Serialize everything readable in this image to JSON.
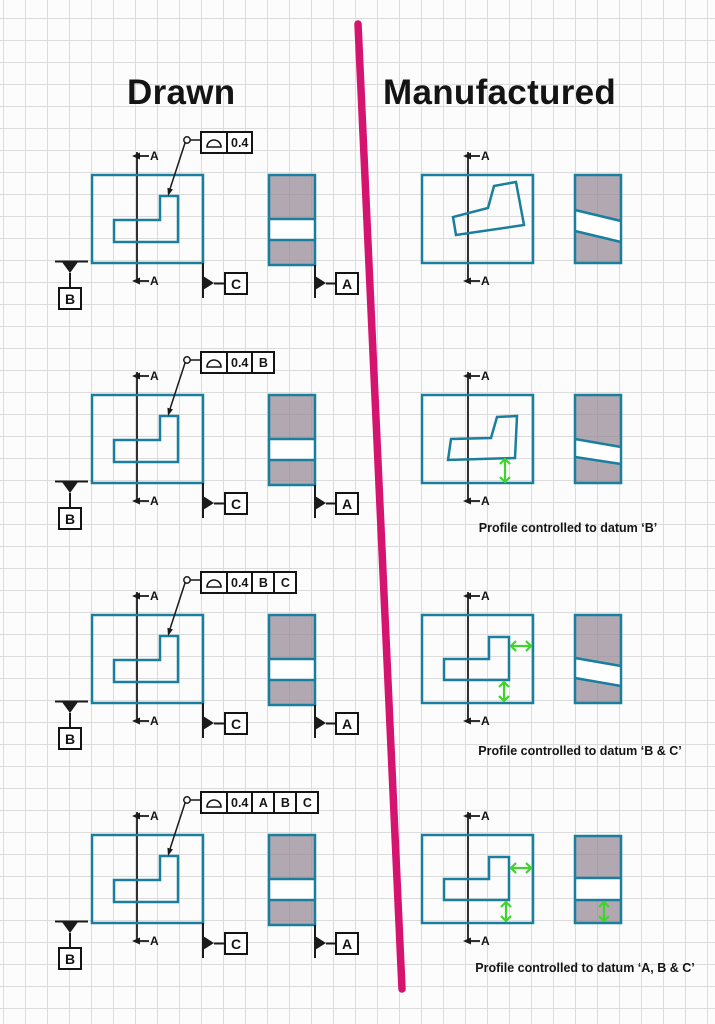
{
  "titles": {
    "drawn": "Drawn",
    "manufactured": "Manufactured"
  },
  "section_label": "A",
  "datums": {
    "a": "A",
    "b": "B",
    "c": "C"
  },
  "fcf_rows": [
    {
      "symbol": "profile-of-a-surface",
      "cells": [
        "0.4"
      ]
    },
    {
      "symbol": "profile-of-a-surface",
      "cells": [
        "0.4",
        "B"
      ]
    },
    {
      "symbol": "profile-of-a-surface",
      "cells": [
        "0.4",
        "B",
        "C"
      ]
    },
    {
      "symbol": "profile-of-a-surface",
      "cells": [
        "0.4",
        "A",
        "B",
        "C"
      ]
    }
  ],
  "captions": {
    "row2": "Profile controlled to datum ‘B’",
    "row3": "Profile controlled to datum ‘B & C’",
    "row4": "Profile controlled to datum ‘A, B & C’"
  },
  "colors": {
    "outline_teal": "#1A7F9E",
    "section_fill_gray": "#A89DA6",
    "deviation_green": "#3FD42C",
    "divider_magenta": "#D4146E",
    "ink_black": "#1A1A1A"
  }
}
